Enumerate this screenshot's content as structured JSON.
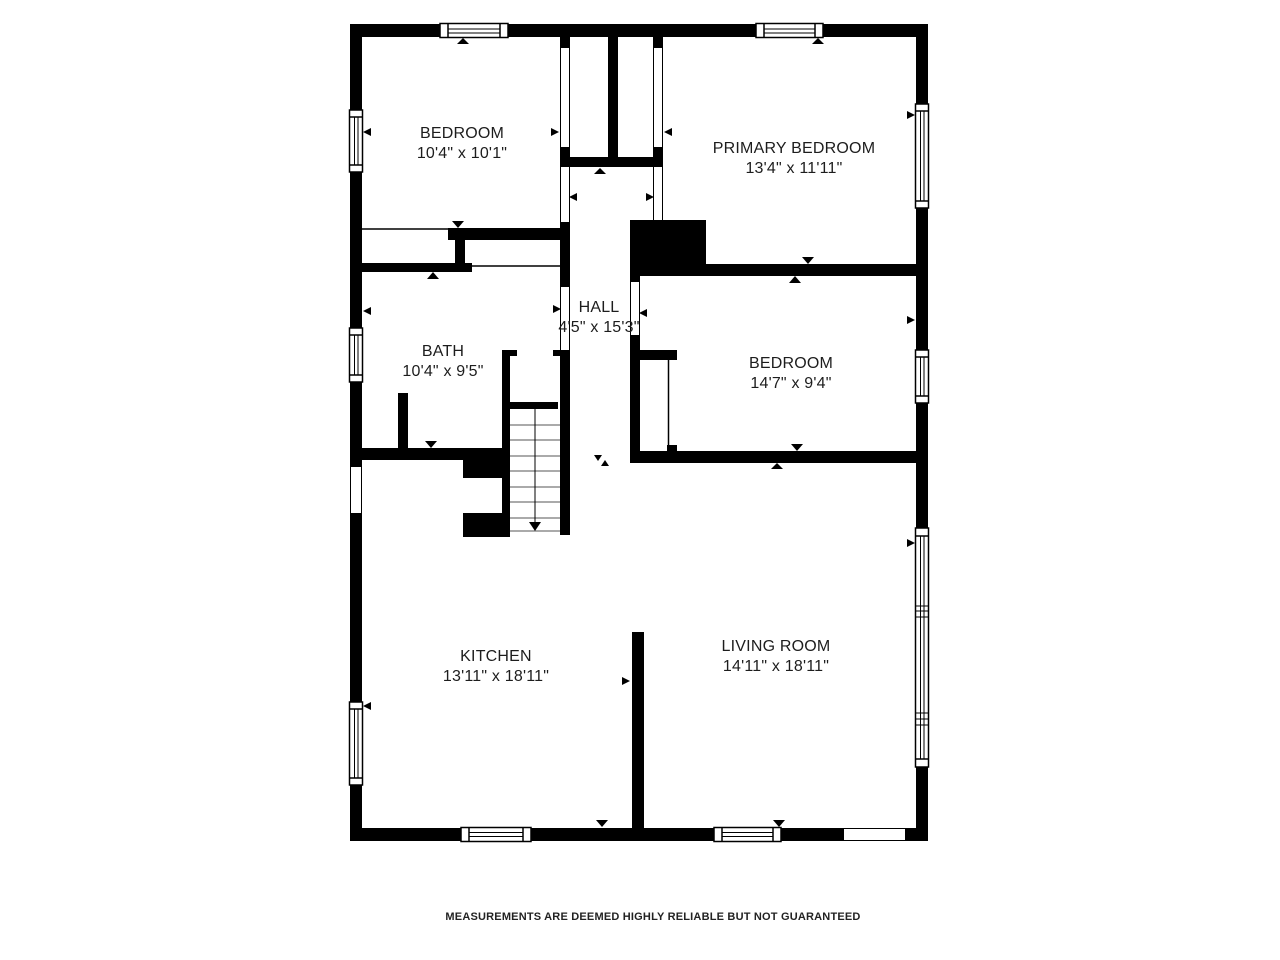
{
  "page": {
    "background": "#ffffff"
  },
  "colors": {
    "wall": "#000000",
    "text": "#1d1d1d",
    "disclaimer": "#222222"
  },
  "rooms": [
    {
      "id": "bedroom-1",
      "name": "BEDROOM",
      "dims": "10'4\" x 10'1\""
    },
    {
      "id": "primary-bedroom",
      "name": "PRIMARY BEDROOM",
      "dims": "13'4\" x 11'11\""
    },
    {
      "id": "hall",
      "name": "HALL",
      "dims": "4'5\" x 15'3\""
    },
    {
      "id": "bath",
      "name": "BATH",
      "dims": "10'4\" x 9'5\""
    },
    {
      "id": "bedroom-2",
      "name": "BEDROOM",
      "dims": "14'7\" x 9'4\""
    },
    {
      "id": "kitchen",
      "name": "KITCHEN",
      "dims": "13'11\" x 18'11\""
    },
    {
      "id": "living-room",
      "name": "LIVING ROOM",
      "dims": "14'11\" x 18'11\""
    }
  ],
  "disclaimer": "MEASUREMENTS ARE DEEMED HIGHLY RELIABLE BUT NOT GUARANTEED",
  "icons": {
    "window": "window-icon",
    "stairs": "stairs-icon",
    "door_marker": "arrow-icon"
  }
}
